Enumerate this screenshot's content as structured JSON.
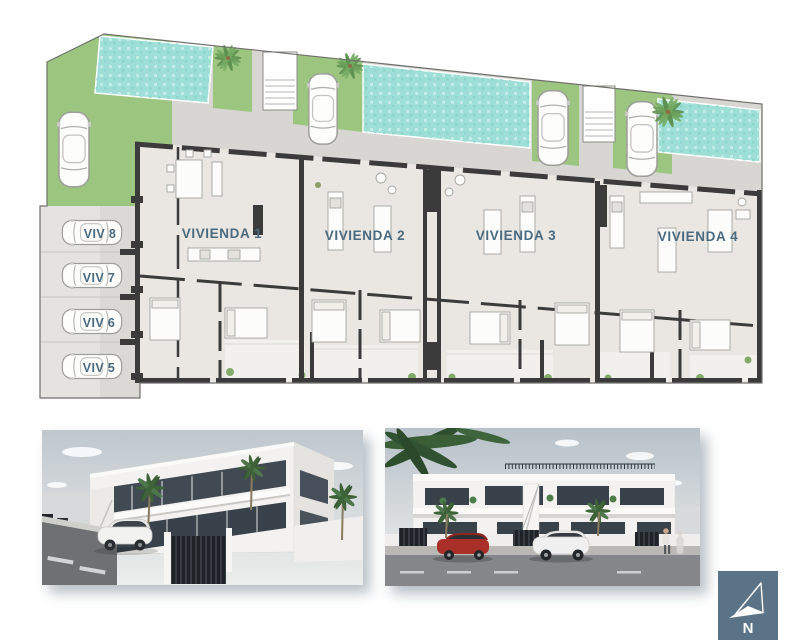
{
  "plan": {
    "units": [
      {
        "label": "VIVIENDA 1"
      },
      {
        "label": "VIVIENDA 2"
      },
      {
        "label": "VIVIENDA 3"
      },
      {
        "label": "VIVIENDA 4"
      }
    ],
    "parking_spots": [
      {
        "label": "VIV 8"
      },
      {
        "label": "VIV 7"
      },
      {
        "label": "VIV 6"
      },
      {
        "label": "VIV 5"
      }
    ]
  },
  "compass": {
    "label": "N"
  },
  "colors": {
    "accent_text": "#4a6a80",
    "pool": "#9ddfd6",
    "grass": "#9cc580",
    "wall": "#3b3b3b",
    "floor": "#eae7e2",
    "driveway": "#d7d6d2",
    "carport": "#e5e3df",
    "compass_bg": "#5b7386"
  }
}
